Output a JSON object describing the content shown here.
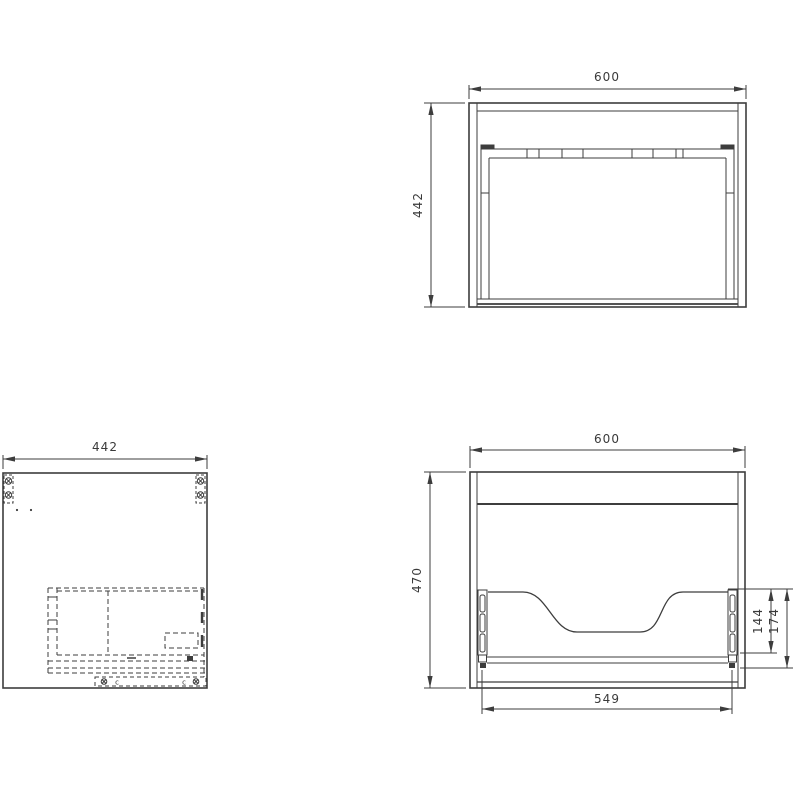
{
  "document": {
    "type": "technical-drawing",
    "subject": "cabinet-three-view-drawing",
    "background": "#ffffff",
    "line_color": "#3d3d3d",
    "text_color": "#3a3a3a"
  },
  "views": {
    "top_view": {
      "label": "top-view",
      "dims": {
        "width": "600",
        "depth": "442"
      }
    },
    "side_view": {
      "label": "side-view",
      "dims": {
        "depth": "442"
      },
      "annotations": {
        "fitting_left": "c",
        "fitting_right": "c"
      }
    },
    "front_view": {
      "label": "rear-view",
      "dims": {
        "width": "600",
        "height": "470",
        "runner_length": "549",
        "cutout_height": "144",
        "rail_offset": "174"
      }
    }
  }
}
